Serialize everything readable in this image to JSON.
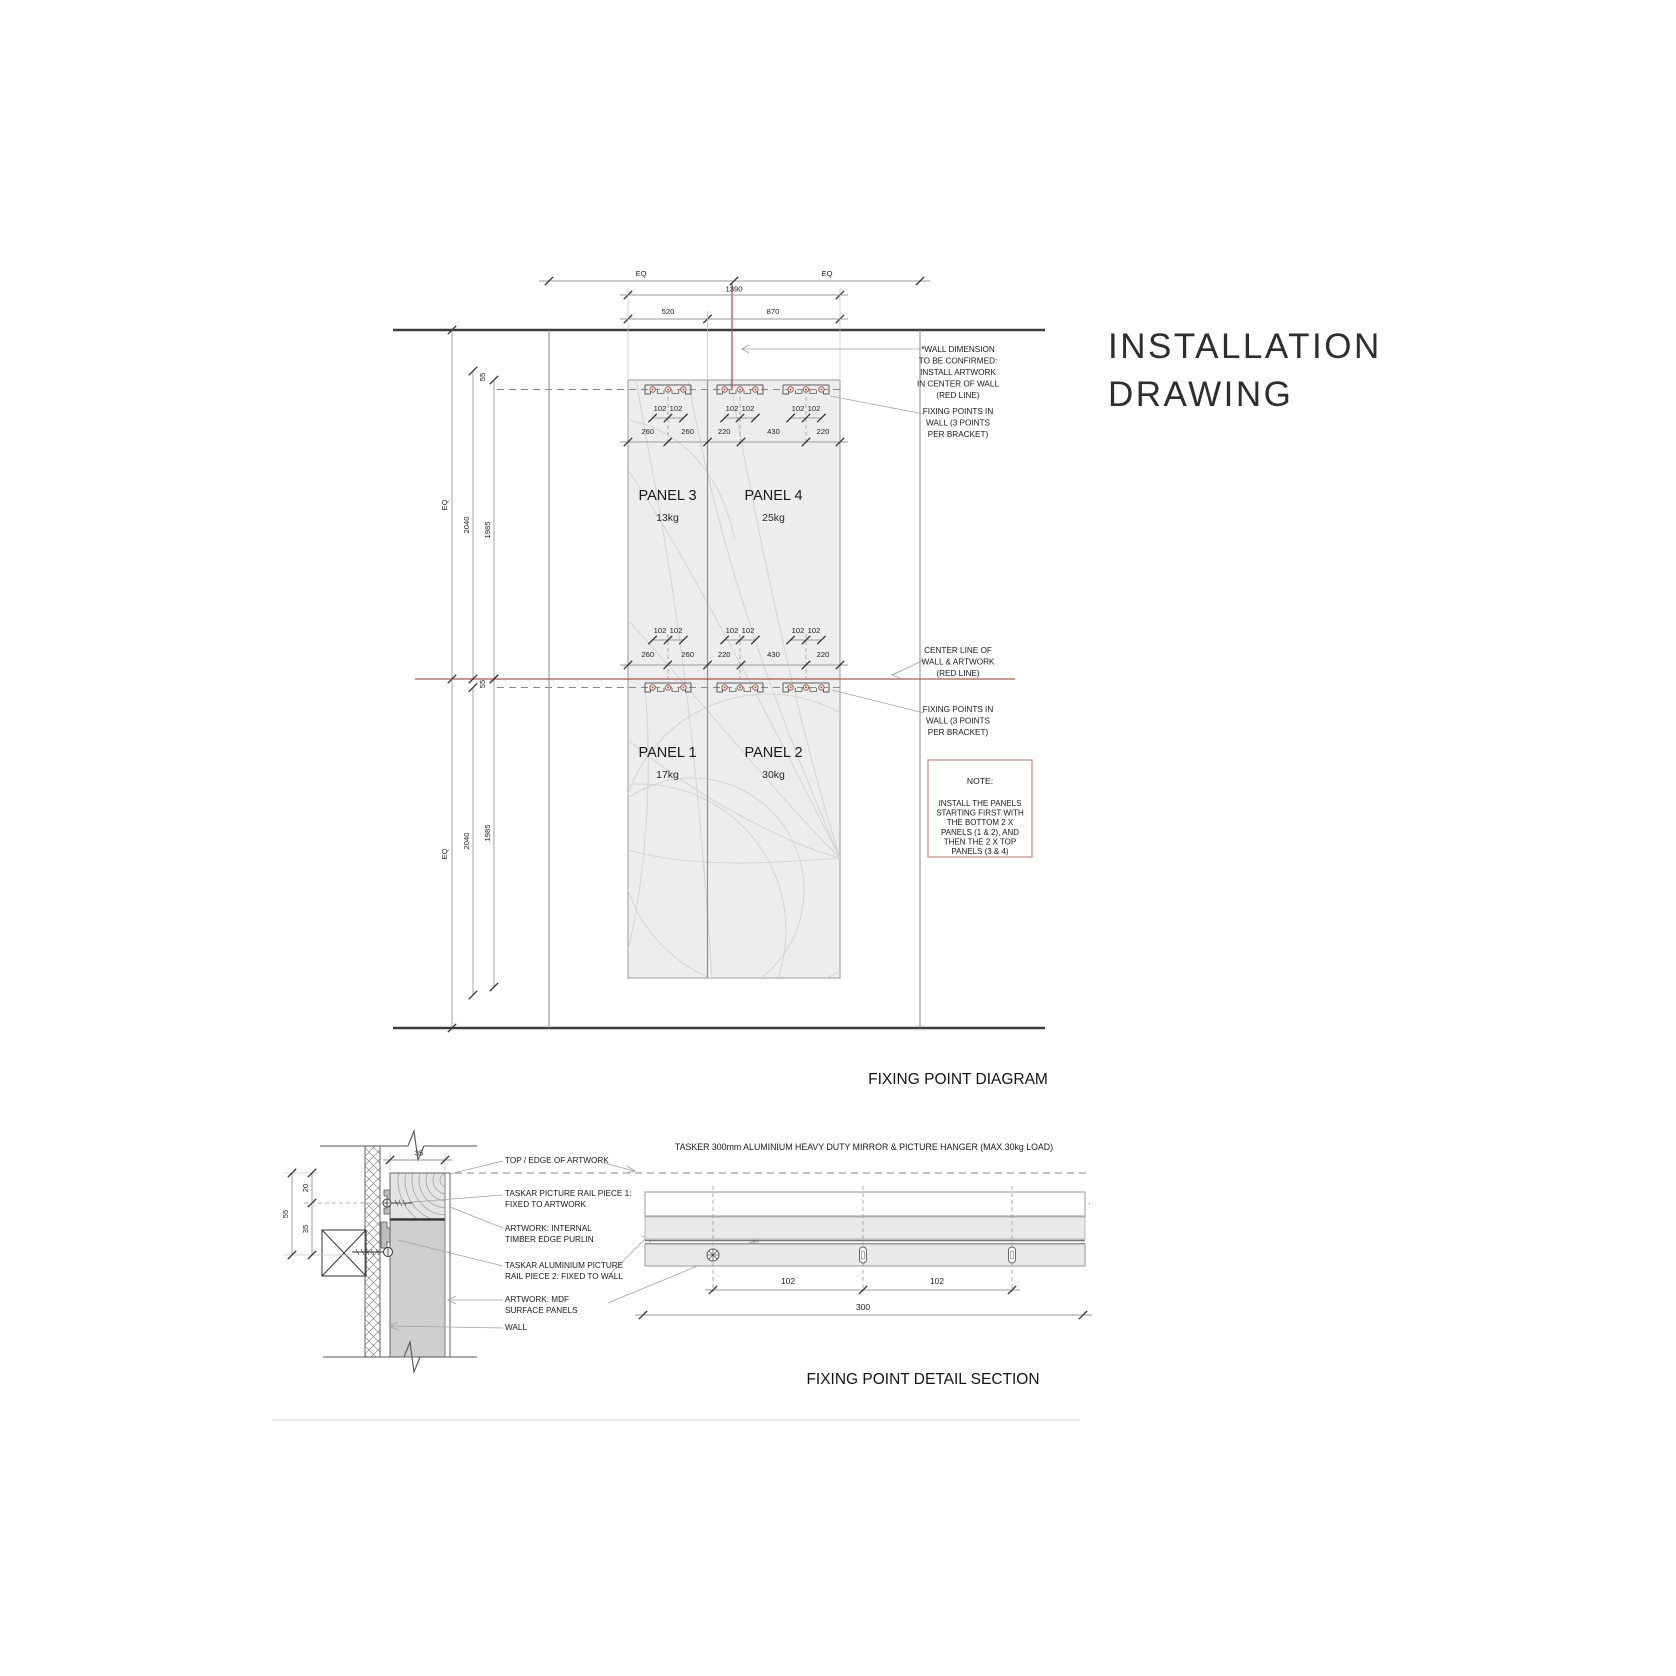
{
  "page": {
    "title": {
      "line1": "INSTALLATION",
      "line2": "DRAWING"
    }
  },
  "colors": {
    "accent_red": "#A85A50",
    "note_border": "#C08A80",
    "panel_fill": "#EDEDED",
    "line_gray": "#8A8A8A",
    "text": "#1A1A1A"
  },
  "fixing_point_diagram": {
    "title": "FIXING POINT DIAGRAM",
    "top_dims": {
      "eq_left": "EQ",
      "eq_right": "EQ",
      "overall": "1390",
      "panel_left": "520",
      "panel_right": "870"
    },
    "side_dims_top": {
      "eq": "EQ",
      "outer": "2040",
      "inner": "1985",
      "offset": "55"
    },
    "side_dims_bottom": {
      "eq": "EQ",
      "outer": "2040",
      "inner": "1985",
      "offset": "55"
    },
    "bracket_spacing": "102",
    "fixing_row": [
      "260",
      "260",
      "220",
      "430",
      "220"
    ],
    "panels": [
      {
        "name": "PANEL 3",
        "weight": "13kg"
      },
      {
        "name": "PANEL 4",
        "weight": "25kg"
      },
      {
        "name": "PANEL 1",
        "weight": "17kg"
      },
      {
        "name": "PANEL 2",
        "weight": "30kg"
      }
    ],
    "annotations": {
      "wall_dimension": [
        "*WALL DIMENSION",
        "TO BE CONFIRMED:",
        "INSTALL ARTWORK",
        "IN CENTER OF WALL",
        "(RED LINE)"
      ],
      "fixing_points_top": [
        "FIXING POINTS IN",
        "WALL (3 POINTS",
        "PER BRACKET)"
      ],
      "center_line": [
        "CENTER LINE OF",
        "WALL & ARTWORK",
        "(RED LINE)"
      ],
      "fixing_points_bottom": [
        "FIXING POINTS IN",
        "WALL (3 POINTS",
        "PER BRACKET)"
      ],
      "note_title": "NOTE:",
      "note_body": [
        "INSTALL THE PANELS",
        "STARTING FIRST WITH",
        "THE BOTTOM 2 X",
        "PANELS (1 & 2), AND",
        "THEN THE 2 X TOP",
        "PANELS (3 & 4)"
      ]
    }
  },
  "detail_section": {
    "title": "FIXING POINT DETAIL SECTION",
    "hanger_spec": "TASKER 300mm ALUMINIUM HEAVY DUTY MIRROR & PICTURE HANGER (MAX 30kg LOAD)",
    "labels": {
      "top_edge": "TOP / EDGE OF ARTWORK",
      "rail_piece_1": [
        "TASKAR PICTURE RAIL PIECE 1:",
        "FIXED TO ARTWORK"
      ],
      "timber_purlin": [
        "ARTWORK: INTERNAL",
        "TIMBER EDGE PURLIN"
      ],
      "rail_piece_2": [
        "TASKAR ALUMINIUM PICTURE",
        "RAIL PIECE 2: FIXED TO WALL"
      ],
      "mdf_panels": [
        "ARTWORK: MDF",
        "SURFACE PANELS"
      ],
      "wall": "WALL"
    },
    "section_dims": {
      "artwork_thickness": "35",
      "overall": "55",
      "top": "20",
      "bottom": "35"
    },
    "rail_dims": {
      "hole_spacing_1": "102",
      "hole_spacing_2": "102",
      "rail_length": "300"
    }
  }
}
